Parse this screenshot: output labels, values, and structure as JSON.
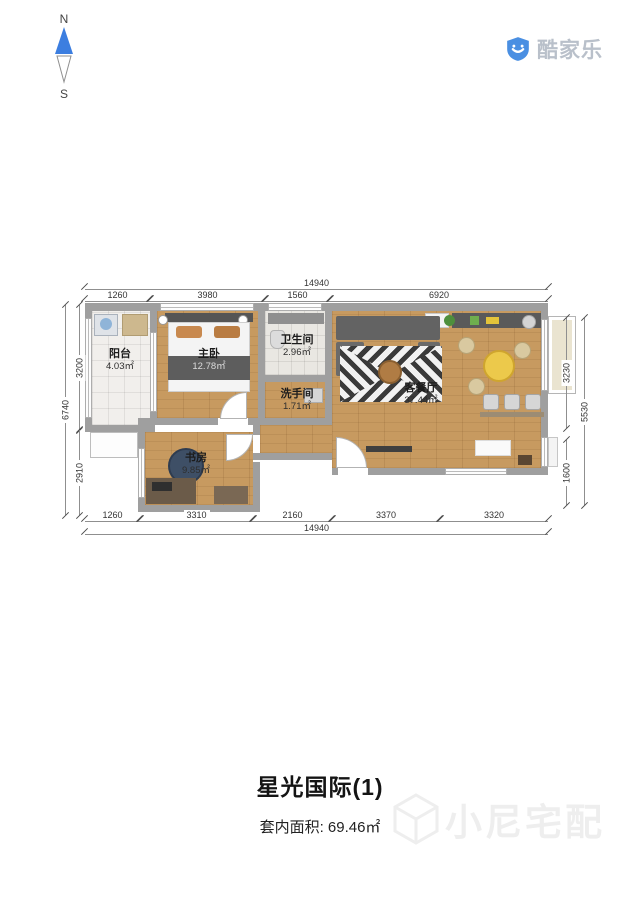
{
  "compass": {
    "north": "N",
    "south": "S"
  },
  "logo": {
    "text": "酷家乐",
    "icon": "shield-smile-icon",
    "blue": "#4a8fe2"
  },
  "plan": {
    "rooms": [
      {
        "name": "阳台",
        "area": "4.03㎡"
      },
      {
        "name": "主卧",
        "area": "12.78㎡"
      },
      {
        "name": "卫生间",
        "area": "2.96㎡"
      },
      {
        "name": "洗手间",
        "area": "1.71㎡"
      },
      {
        "name": "客餐厅",
        "area": "37.44㎡"
      },
      {
        "name": "书房",
        "area": "9.85㎡"
      }
    ],
    "dimensions": {
      "top_total": "14940",
      "top_segments": [
        "1260",
        "3980",
        "1560",
        "6920"
      ],
      "bottom_segments": [
        "1260",
        "3310",
        "2160",
        "3370",
        "3320"
      ],
      "bottom_total": "14940",
      "left_segments": [
        "3200",
        "2910"
      ],
      "left_total": "6740",
      "right_segments": [
        "3230",
        "1600"
      ],
      "right_total": "5530"
    },
    "colors": {
      "wall": "#9f9f9f",
      "wood_floor": "#c79a60",
      "dining_table_yellow": "#ecc94b",
      "study_chair_navy": "#3e4f66"
    }
  },
  "footer": {
    "title": "星光国际(1)",
    "area_label": "套内面积: 69.46㎡"
  },
  "watermark": {
    "text": "小尼宅配",
    "icon": "cube-icon"
  }
}
